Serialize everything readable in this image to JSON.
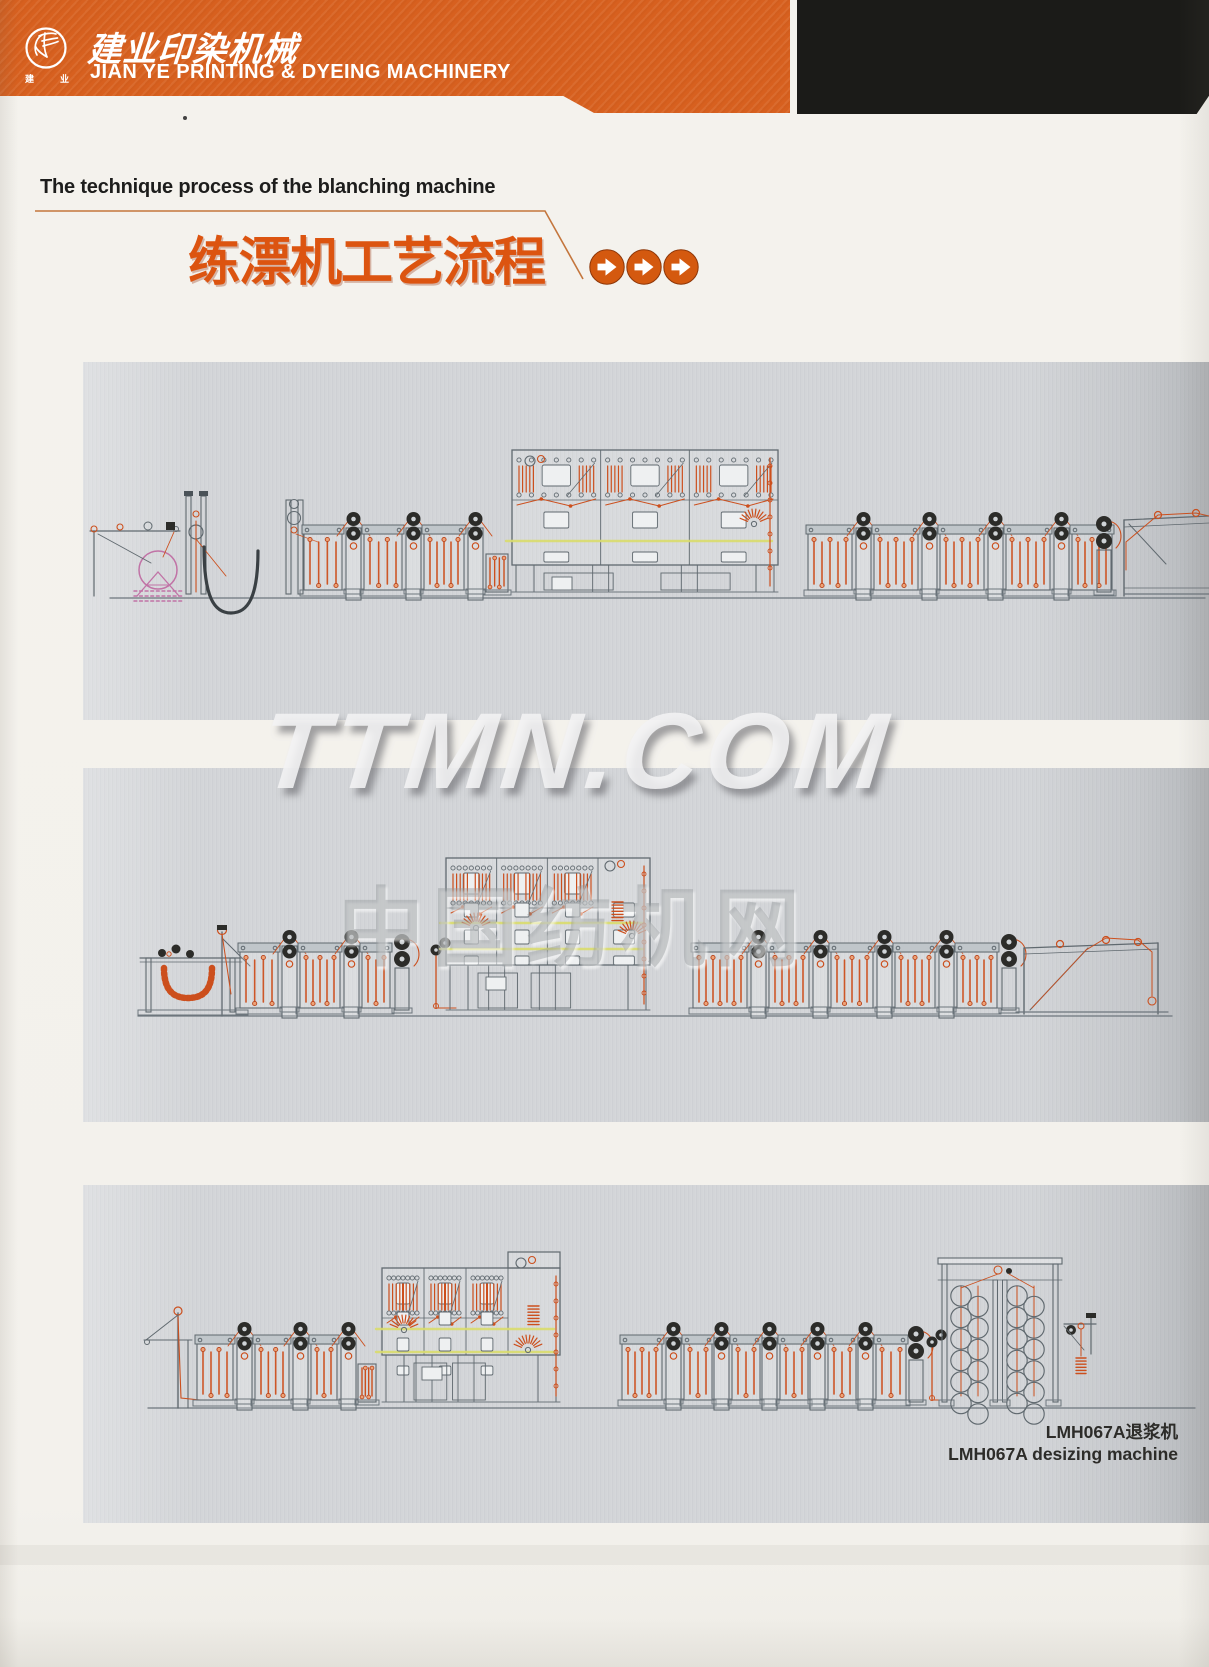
{
  "page": {
    "w": 1209,
    "h": 1667
  },
  "header": {
    "band_color": "#d7601f",
    "black_color": "#1b1b18",
    "company_zh": "建业印染机械",
    "company_en": "JIAN YE PRINTING & DYEING MACHINERY",
    "logo_chars": [
      "建",
      "业"
    ]
  },
  "title": {
    "en": "The technique process of the blanching machine",
    "zh": "练漂机工艺流程",
    "accent": "#d4590f",
    "arrows": 3
  },
  "watermark": {
    "latin": "TTMN.COM",
    "zh": "中国纺机网"
  },
  "caption": {
    "zh": "LMH067A退浆机",
    "en": "LMH067A desizing machine"
  },
  "colors": {
    "steel": "#60696f",
    "steel_dark": "#6d767d",
    "orange": "#cc4f1d",
    "orange_fill": "#eda277",
    "dark": "#2c2c29",
    "yellow": "#d9dc6c",
    "pink": "#c173a6",
    "lid": "#c0c6ca",
    "door": "#eef0f1"
  },
  "panels": [
    {
      "x": 83,
      "y": 362,
      "w": 1126,
      "h": 358,
      "floor": 600,
      "floor_x1": 110,
      "floor_x2": 1205,
      "modules": [
        {
          "t": "unwinder",
          "x": 118
        },
        {
          "t": "entryframe",
          "x": 186
        },
        {
          "t": "jloop",
          "x1": 204,
          "x2": 258,
          "top": 547,
          "bot": 613
        },
        {
          "t": "frame2",
          "x": 286
        },
        {
          "t": "wash",
          "x": 304,
          "w": 38
        },
        {
          "t": "squeeze",
          "x": 346
        },
        {
          "t": "wash",
          "x": 364,
          "w": 38
        },
        {
          "t": "squeeze",
          "x": 406
        },
        {
          "t": "wash",
          "x": 424,
          "w": 40
        },
        {
          "t": "squeeze",
          "x": 468
        },
        {
          "t": "smallunit",
          "x": 486,
          "w": 22
        },
        {
          "t": "steamer",
          "x": 512,
          "w": 266,
          "top": 450,
          "bodyBot": 565,
          "bays": 3,
          "yellow": [
            541
          ],
          "doorRows": [
            {
              "y": 512,
              "h": 16
            },
            {
              "y": 552,
              "h": 10
            }
          ],
          "fans": [
            {
              "x": 754,
              "y": 524
            }
          ],
          "exitX": 770,
          "cluster": {
            "x": 530,
            "y": 461
          }
        },
        {
          "t": "wash",
          "x": 808,
          "w": 44
        },
        {
          "t": "squeeze",
          "x": 856
        },
        {
          "t": "wash",
          "x": 874,
          "w": 44
        },
        {
          "t": "squeeze",
          "x": 922
        },
        {
          "t": "wash",
          "x": 940,
          "w": 44
        },
        {
          "t": "squeeze",
          "x": 988
        },
        {
          "t": "wash",
          "x": 1006,
          "w": 44
        },
        {
          "t": "squeeze",
          "x": 1054
        },
        {
          "t": "wash",
          "x": 1072,
          "w": 40
        },
        {
          "t": "exitstand",
          "x": 1096
        },
        {
          "t": "outframe",
          "x": 1124
        }
      ]
    },
    {
      "x": 83,
      "y": 768,
      "w": 1126,
      "h": 354,
      "floor": 1018,
      "floor_x1": 138,
      "floor_x2": 1172,
      "modules": [
        {
          "t": "scray",
          "x": 146
        },
        {
          "t": "wash",
          "x": 240,
          "w": 38
        },
        {
          "t": "squeeze",
          "x": 282
        },
        {
          "t": "wash",
          "x": 300,
          "w": 40
        },
        {
          "t": "squeeze",
          "x": 344
        },
        {
          "t": "wash",
          "x": 362,
          "w": 28
        },
        {
          "t": "exitstand",
          "x": 394
        },
        {
          "t": "riser",
          "x": 436
        },
        {
          "t": "steamer",
          "x": 446,
          "w": 152,
          "annexW": 52,
          "top": 858,
          "bodyBot": 965,
          "bays": 3,
          "yellow": [
            923,
            949
          ],
          "doorRows": [
            {
              "y": 903,
              "h": 14
            },
            {
              "y": 930,
              "h": 14
            },
            {
              "y": 956,
              "h": 9
            }
          ],
          "fans": [
            {
              "x": 476,
              "y": 928
            },
            {
              "x": 632,
              "y": 936
            }
          ],
          "springs": [
            {
              "x": 612,
              "y": 902
            }
          ],
          "exitX": 644,
          "cluster": {
            "x": 610,
            "y": 866
          }
        },
        {
          "t": "wash",
          "x": 693,
          "w": 54
        },
        {
          "t": "squeeze",
          "x": 751
        },
        {
          "t": "wash",
          "x": 769,
          "w": 40
        },
        {
          "t": "squeeze",
          "x": 813
        },
        {
          "t": "wash",
          "x": 831,
          "w": 42
        },
        {
          "t": "squeeze",
          "x": 877
        },
        {
          "t": "wash",
          "x": 895,
          "w": 40
        },
        {
          "t": "squeeze",
          "x": 939
        },
        {
          "t": "wash",
          "x": 957,
          "w": 40
        },
        {
          "t": "exitstand",
          "x": 1001
        },
        {
          "t": "plaiter",
          "x": 1018,
          "w": 140
        }
      ]
    },
    {
      "x": 83,
      "y": 1185,
      "w": 1126,
      "h": 338,
      "floor": 1410,
      "floor_x1": 148,
      "floor_x2": 1195,
      "modules": [
        {
          "t": "mast3",
          "x": 178
        },
        {
          "t": "wash",
          "x": 197,
          "w": 36
        },
        {
          "t": "squeeze",
          "x": 237
        },
        {
          "t": "wash",
          "x": 255,
          "w": 34
        },
        {
          "t": "squeeze",
          "x": 293
        },
        {
          "t": "wash",
          "x": 311,
          "w": 26
        },
        {
          "t": "squeeze",
          "x": 341
        },
        {
          "t": "smallunit",
          "x": 358,
          "w": 18
        },
        {
          "t": "steamer",
          "x": 382,
          "w": 126,
          "top": 1268,
          "bodyBot": 1355,
          "bays": 3,
          "yellow": [
            1329,
            1352
          ],
          "doorRows": [
            {
              "y": 1312,
              "h": 13
            },
            {
              "y": 1338,
              "h": 13
            },
            {
              "y": 1366,
              "h": 9
            }
          ],
          "fans": [
            {
              "x": 404,
              "y": 1330
            },
            {
              "x": 528,
              "y": 1350
            }
          ],
          "springs": [
            {
              "x": 528,
              "y": 1306
            }
          ],
          "tower": {
            "x": 508,
            "w": 52,
            "t": 1252
          },
          "exitX": 556
        },
        {
          "t": "wash",
          "x": 622,
          "w": 40
        },
        {
          "t": "squeeze",
          "x": 666
        },
        {
          "t": "wash",
          "x": 684,
          "w": 28
        },
        {
          "t": "squeeze",
          "x": 714
        },
        {
          "t": "wash",
          "x": 732,
          "w": 28
        },
        {
          "t": "squeeze",
          "x": 762
        },
        {
          "t": "wash",
          "x": 780,
          "w": 28
        },
        {
          "t": "squeeze",
          "x": 810
        },
        {
          "t": "wash",
          "x": 828,
          "w": 28
        },
        {
          "t": "squeeze",
          "x": 858
        },
        {
          "t": "wash",
          "x": 876,
          "w": 30
        },
        {
          "t": "exitstand",
          "x": 908
        },
        {
          "t": "riser",
          "x": 932
        },
        {
          "t": "cylinders",
          "x": 942,
          "w": 116,
          "top": 1258
        },
        {
          "t": "bracket",
          "x": 1064
        }
      ]
    }
  ]
}
